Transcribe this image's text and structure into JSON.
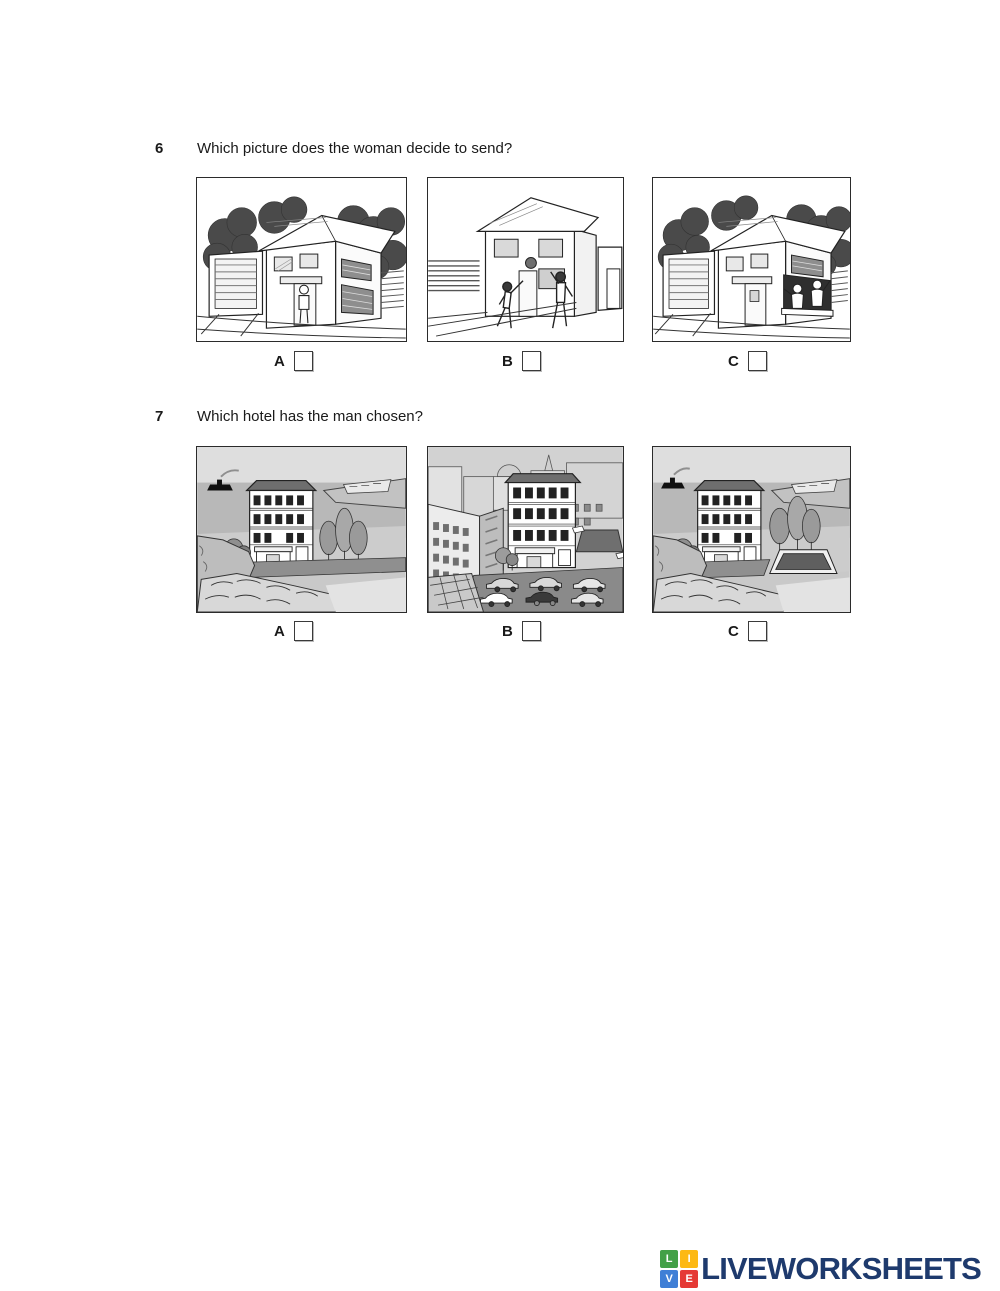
{
  "questions": [
    {
      "number": "6",
      "text": "Which picture does the woman decide to send?",
      "options": [
        {
          "label": "A",
          "description": "house with a woman standing at the front door"
        },
        {
          "label": "B",
          "description": "two people playing with a ball in front of the house"
        },
        {
          "label": "C",
          "description": "two people waving from the downstairs window of the house"
        }
      ]
    },
    {
      "number": "7",
      "text": "Which hotel has the man chosen?",
      "options": [
        {
          "label": "A",
          "description": "hotel by the sea with trees beside it"
        },
        {
          "label": "B",
          "description": "hotel in the town centre with a car park in front"
        },
        {
          "label": "C",
          "description": "hotel by the sea with a swimming pool"
        }
      ]
    }
  ],
  "footer": {
    "logo_text": "LIVEWORKSHEETS",
    "logo_text_color": "#1e3a6d",
    "logo_tiles": [
      {
        "letter": "L",
        "color": "#43a047"
      },
      {
        "letter": "I",
        "color": "#fdb913"
      },
      {
        "letter": "V",
        "color": "#3f7fd6"
      },
      {
        "letter": "E",
        "color": "#e53935"
      }
    ]
  }
}
